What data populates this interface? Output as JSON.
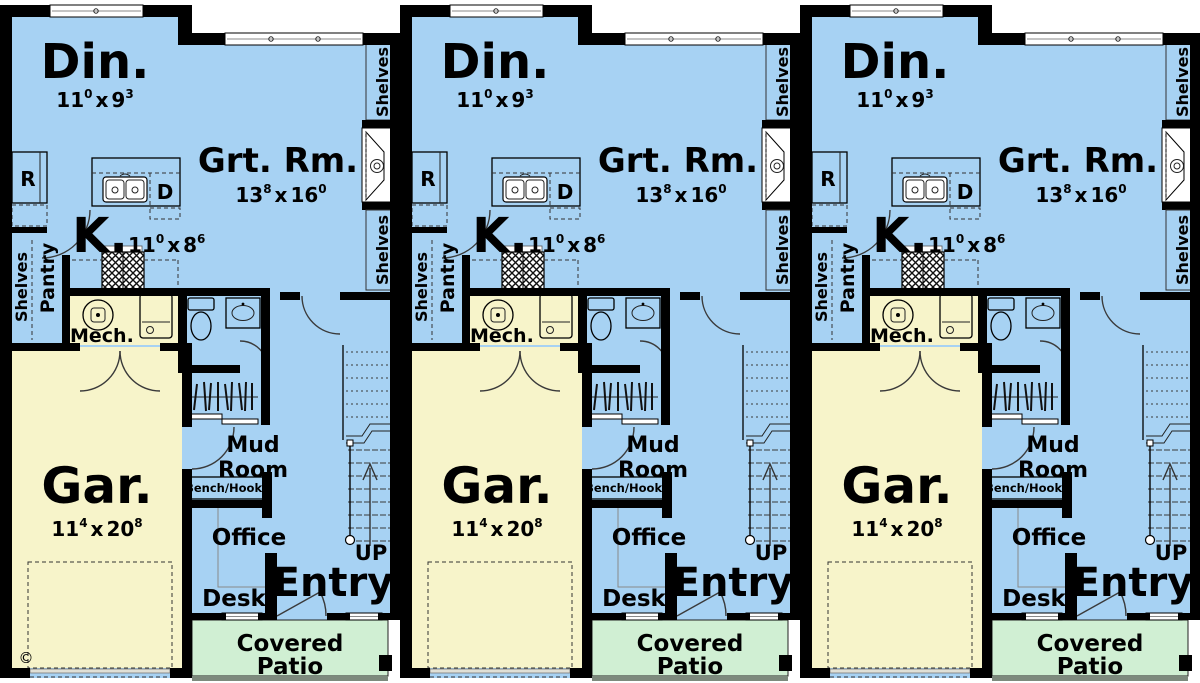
{
  "plan": {
    "unit_count": 3,
    "colors": {
      "floor_blue": "#a7d2f3",
      "garage_cream": "#f7f4ca",
      "patio_green": "#d0efd3",
      "wall_black": "#000000",
      "exterior_white": "#ffffff"
    },
    "rooms": {
      "dining": {
        "label": "Din.",
        "dim": {
          "a": "11",
          "a_sup": "0",
          "sep": "x",
          "b": "9",
          "b_sup": "3"
        }
      },
      "great_room": {
        "label": "Grt. Rm.",
        "dim": {
          "a": "13",
          "a_sup": "8",
          "sep": "x",
          "b": "16",
          "b_sup": "0"
        }
      },
      "kitchen": {
        "label": "K.",
        "dim": {
          "a": "11",
          "a_sup": "0",
          "sep": "x",
          "b": "8",
          "b_sup": "6"
        }
      },
      "garage": {
        "label": "Gar.",
        "dim": {
          "a": "11",
          "a_sup": "4",
          "sep": "x",
          "b": "20",
          "b_sup": "8"
        }
      },
      "mech": {
        "label": "Mech."
      },
      "mud_room": {
        "line1": "Mud",
        "line2": "Room"
      },
      "office": {
        "label": "Office"
      },
      "entry": {
        "label": "Entry"
      },
      "covered_patio": {
        "line1": "Covered",
        "line2": "Patio"
      }
    },
    "features": {
      "shelves": "Shelves",
      "pantry": "Pantry",
      "bench_hooks": "Bench/Hooks",
      "desk": "Desk",
      "up": "UP",
      "refrigerator": "R",
      "dishwasher": "D",
      "copyright": "©"
    }
  }
}
